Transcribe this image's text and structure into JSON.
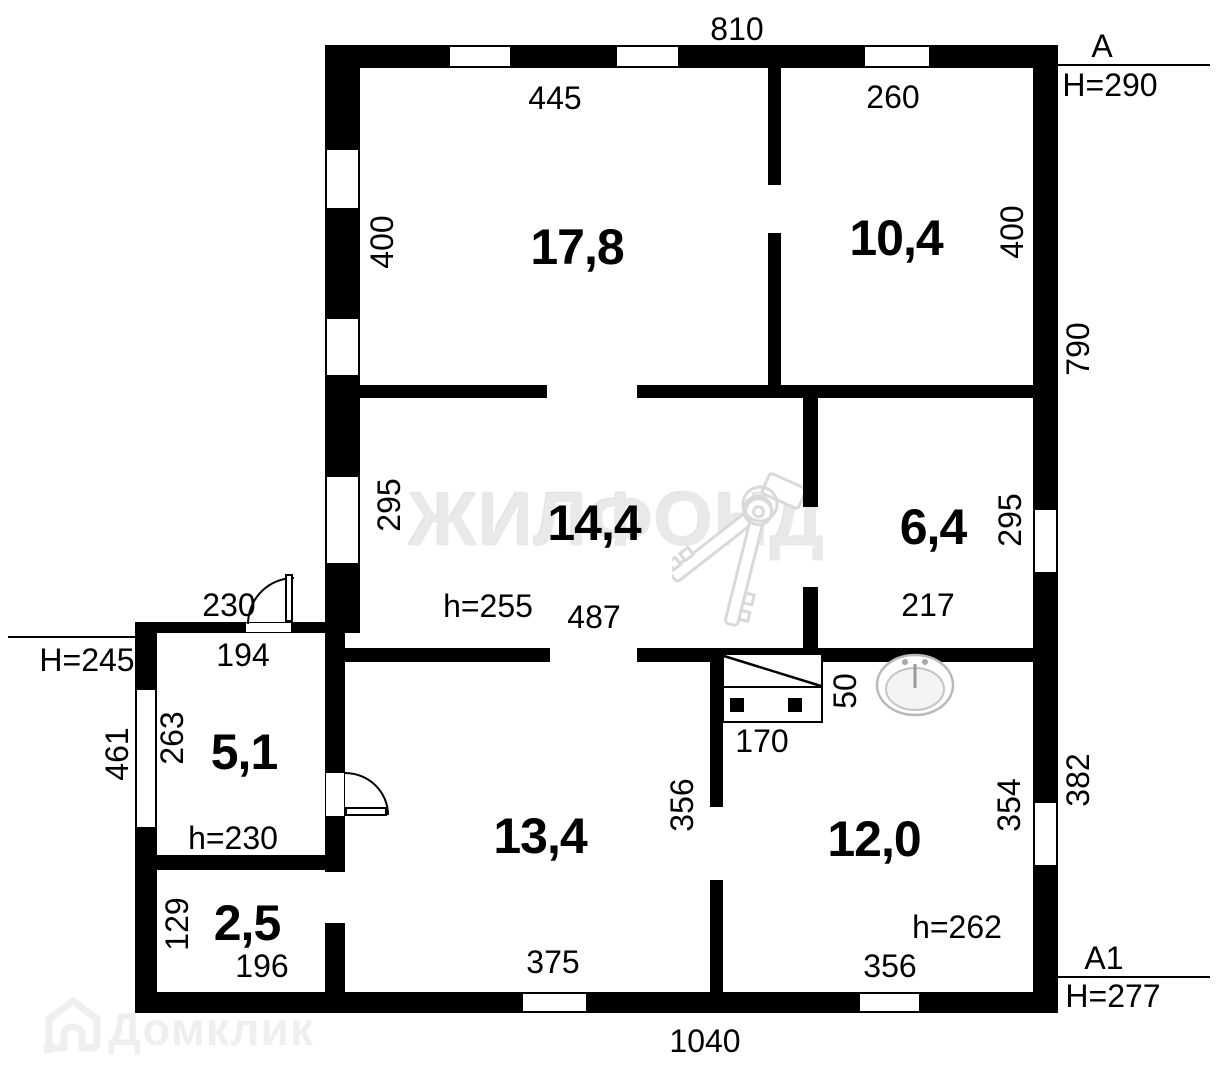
{
  "labels": {
    "dim_810": "810",
    "dim_445": "445",
    "dim_260": "260",
    "mark_a": "A",
    "mark_h290": "H=290",
    "dim_400_left": "400",
    "dim_400_right": "400",
    "dim_790": "790",
    "dim_295_left": "295",
    "dim_295_right": "295",
    "dim_h255": "h=255",
    "dim_487": "487",
    "dim_217": "217",
    "dim_230": "230",
    "dim_194": "194",
    "mark_h245": "H=245",
    "dim_461": "461",
    "dim_263": "263",
    "dim_h230": "h=230",
    "dim_129": "129",
    "dim_196": "196",
    "dim_375": "375",
    "dim_356_mid": "356",
    "dim_170": "170",
    "dim_50": "50",
    "dim_354": "354",
    "dim_382": "382",
    "dim_h262": "h=262",
    "dim_356_bot": "356",
    "mark_a1": "A1",
    "mark_h277": "H=277",
    "dim_1040": "1040"
  },
  "rooms": {
    "r17_8": "17,8",
    "r10_4": "10,4",
    "r14_4": "14,4",
    "r6_4": "6,4",
    "r5_1": "5,1",
    "r2_5": "2,5",
    "r13_4": "13,4",
    "r12_0": "12,0"
  },
  "watermarks": {
    "brand": "ЖИЛФОНД",
    "portal": "Домклик"
  },
  "colors": {
    "wall": "#000000",
    "background": "#ffffff",
    "watermark_gray": "#e9e9e9"
  }
}
